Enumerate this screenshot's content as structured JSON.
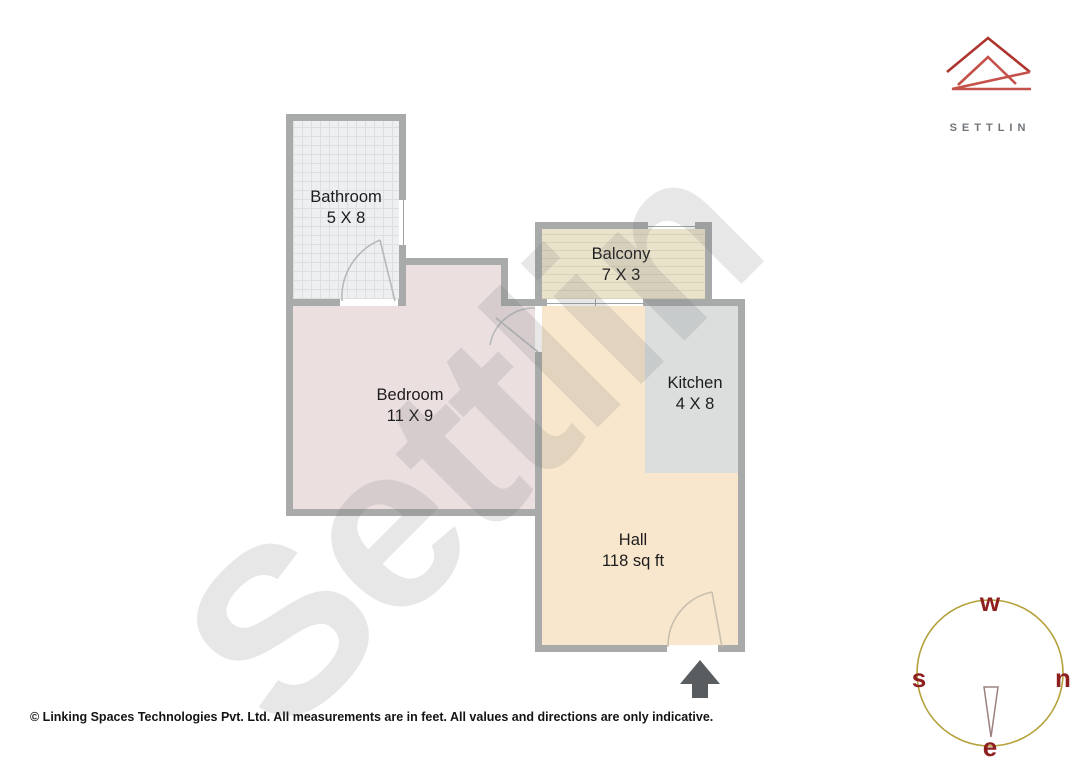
{
  "logo": {
    "brand": "SETTLIN"
  },
  "watermark": {
    "text": "Settlin"
  },
  "rooms": {
    "bathroom": {
      "name": "Bathroom",
      "dims": "5 X 8"
    },
    "balcony": {
      "name": "Balcony",
      "dims": "7 X 3"
    },
    "bedroom": {
      "name": "Bedroom",
      "dims": "11 X 9"
    },
    "kitchen": {
      "name": "Kitchen",
      "dims": "4 X 8"
    },
    "hall": {
      "name": "Hall",
      "dims": "118 sq ft"
    }
  },
  "compass": {
    "top": "w",
    "left": "s",
    "right": "n",
    "bottom": "e"
  },
  "footer": {
    "text": "© Linking Spaces Technologies Pvt. Ltd. All measurements are in feet. All values and directions are only indicative."
  },
  "colors": {
    "wall": "#a9abaa",
    "bathroom_floor": "#edeff1",
    "bedroom_floor": "#ebdfdf",
    "balcony_floor": "#eae3cb",
    "hall_floor": "#f8e7cd",
    "kitchen_floor": "#dbdedd",
    "logo_red_dark": "#ae342e",
    "logo_red_light": "#c4514a",
    "compass_circle": "#b4a13b",
    "compass_letters": "#8e1f1f",
    "entrance_arrow": "#595d5f"
  }
}
